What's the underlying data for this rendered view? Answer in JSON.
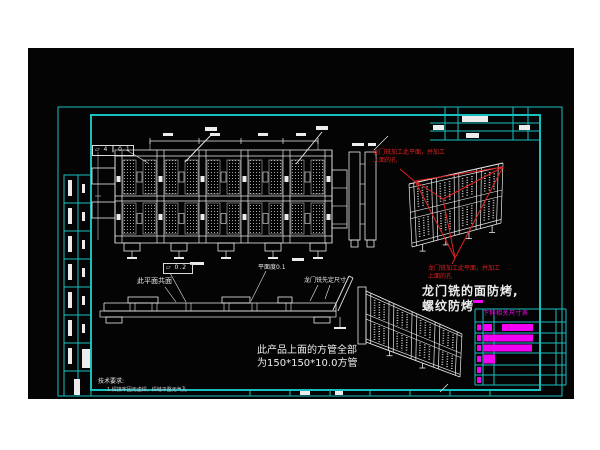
{
  "drawing": {
    "title": "gantry-welded-frame-assembly-drawing",
    "colors": {
      "paper": "#ffffff",
      "model_space": "#040404",
      "frame_cyan": "#17bfbf",
      "linework_white": "#ececec",
      "annotation_red": "#e02020",
      "highlight_magenta": "#f202f2"
    },
    "annotations": {
      "red_note_top": {
        "line1": "龙门铣加工此平面，并加工",
        "line2": "上面的孔"
      },
      "red_note_bottom": {
        "line1": "龙门铣加工此平面，并加工",
        "line2": "上面的孔"
      },
      "bake_note": {
        "line1": "龙门铣的面防烤,",
        "line2": "螺纹防烤"
      },
      "tube_note": {
        "line1": "此产品上面的方管全部",
        "line2": "为150*150*10.0方管"
      },
      "coplanar_label": "此平面共面",
      "flatness_label": "平面度0.1",
      "gantry_dim_label": "龙门铣先定尺寸",
      "fcf_top": "▱ 4 ‖ 0.1",
      "fcf_side": "▱ 0.2"
    },
    "tech_requirements": {
      "title": "技术要求:",
      "item1": "1.焊接牢固无虚焊，焊缝平整无气孔"
    },
    "bom_table": {
      "header": "下料相关尺寸表",
      "row_tops": [
        322,
        333,
        343,
        353,
        365,
        375
      ],
      "row_heights": [
        11,
        10,
        10,
        12,
        10,
        10
      ],
      "rows": [
        {
          "marks": [
            [
              477,
              4,
              6
            ],
            [
              483,
              9,
              7
            ],
            [
              502,
              31,
              7
            ]
          ]
        },
        {
          "marks": [
            [
              477,
              4,
              6
            ],
            [
              483,
              50,
              7
            ]
          ]
        },
        {
          "marks": [
            [
              477,
              4,
              6
            ],
            [
              483,
              49,
              7
            ]
          ]
        },
        {
          "marks": [
            [
              477,
              4,
              6
            ],
            [
              483,
              12,
              9
            ]
          ]
        },
        {
          "marks": [
            [
              477,
              4,
              6
            ]
          ]
        },
        {
          "marks": [
            [
              477,
              4,
              6
            ]
          ]
        }
      ]
    },
    "left_strip_rows": 8
  }
}
